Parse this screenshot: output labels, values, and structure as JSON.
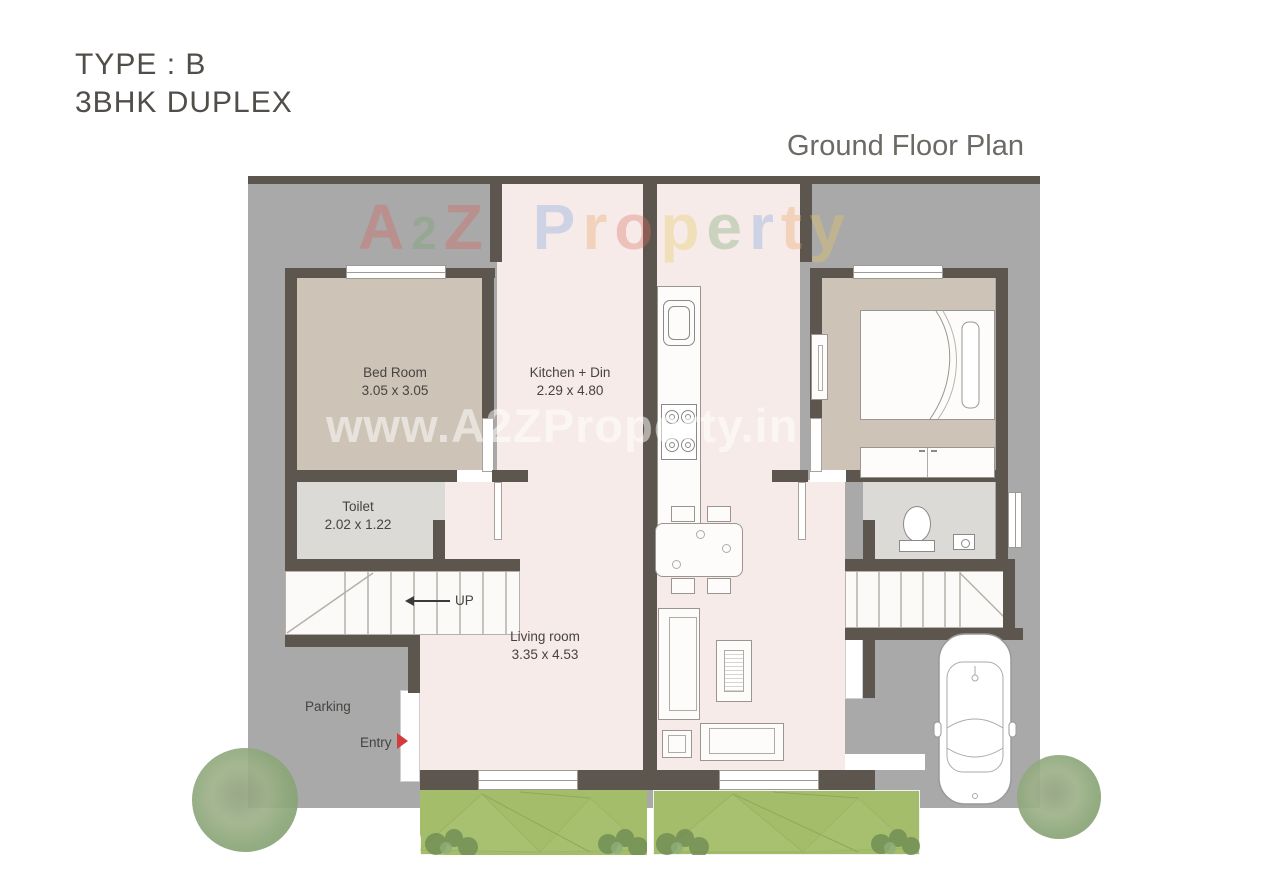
{
  "header": {
    "type_label": "TYPE : B",
    "unit_label": "3BHK DUPLEX",
    "plan_title": "Ground Floor Plan"
  },
  "watermark": {
    "brand": "A2Z Property",
    "brand_letters": [
      {
        "ch": "A",
        "color": "#d9615a"
      },
      {
        "ch": "2",
        "color": "#74a86d",
        "small": true
      },
      {
        "ch": "Z",
        "color": "#d9615a"
      },
      {
        "ch": " "
      },
      {
        "ch": "P",
        "color": "#84a4e2"
      },
      {
        "ch": "r",
        "color": "#eda463"
      },
      {
        "ch": "o",
        "color": "#dd6f62"
      },
      {
        "ch": "p",
        "color": "#e9c960"
      },
      {
        "ch": "e",
        "color": "#74a86d"
      },
      {
        "ch": "r",
        "color": "#84a4e2"
      },
      {
        "ch": "t",
        "color": "#eda463"
      },
      {
        "ch": "y",
        "color": "#e9c960"
      }
    ],
    "url": "www.A2ZProperty.in"
  },
  "labels": {
    "bedroom_name": "Bed Room",
    "bedroom_dims": "3.05 x 3.05",
    "kitchen_name": "Kitchen + Din",
    "kitchen_dims": "2.29 x 4.80",
    "toilet_name": "Toilet",
    "toilet_dims": "2.02 x 1.22",
    "living_name": "Living room",
    "living_dims": "3.35 x 4.53",
    "parking": "Parking",
    "entry": "Entry",
    "up": "UP"
  },
  "colors": {
    "plot": "#a9a9a9",
    "wall": "#5d564f",
    "unit_floor": "#f6ebe8",
    "bedroom_floor": "#cdc3b7",
    "toilet_floor": "#dcdad6",
    "lawn": "#a3bd6b",
    "entry_arrow": "#d23c3c"
  }
}
